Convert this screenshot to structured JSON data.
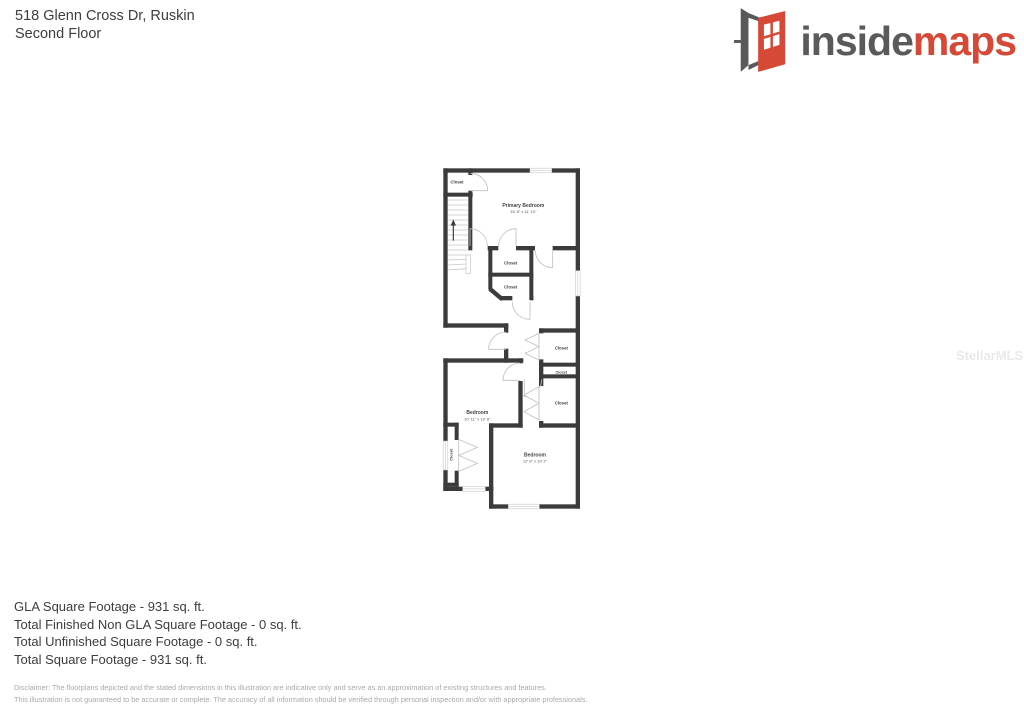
{
  "header": {
    "address": "518 Glenn Cross Dr, Ruskin",
    "floor": "Second Floor"
  },
  "logo": {
    "part1": "inside",
    "part2": "maps",
    "gray_color": "#595a5c",
    "red_color": "#d64937",
    "icon": "open-door-icon"
  },
  "watermark": "StellarMLS",
  "floorplan": {
    "wall_color": "#3b3b3b",
    "rooms": {
      "closet_top_left": {
        "label": "Closet"
      },
      "primary_bedroom": {
        "label": "Primary Bedroom",
        "dims": "16' 8\" x 11' 10\""
      },
      "closet_mid_1": {
        "label": "Closet"
      },
      "closet_mid_2": {
        "label": "Closet"
      },
      "closet_right_1": {
        "label": "Closet"
      },
      "closet_right_2": {
        "label": "Closet"
      },
      "closet_right_3": {
        "label": "Closet"
      },
      "bedroom_left": {
        "label": "Bedroom",
        "dims": "10' 11\" x 19' 8\""
      },
      "closet_bedroom_left": {
        "label": "Closet"
      },
      "bedroom_right": {
        "label": "Bedroom",
        "dims": "12' 9\" x 19' 2\""
      }
    }
  },
  "summary": {
    "lines": [
      "GLA Square Footage - 931 sq. ft.",
      "Total Finished Non GLA Square Footage - 0 sq. ft.",
      "Total Unfinished Square Footage - 0 sq. ft.",
      "Total Square Footage - 931 sq. ft."
    ]
  },
  "disclaimer": {
    "line1": "Disclaimer: The floorplans depicted and the stated dimensions in this illustration are indicative only and serve as an approximation of existing structures and features.",
    "line2": "This illustration is not guaranteed to be accurate or complete. The accuracy of all information should be verified through personal inspection and/or with appropriate professionals."
  }
}
